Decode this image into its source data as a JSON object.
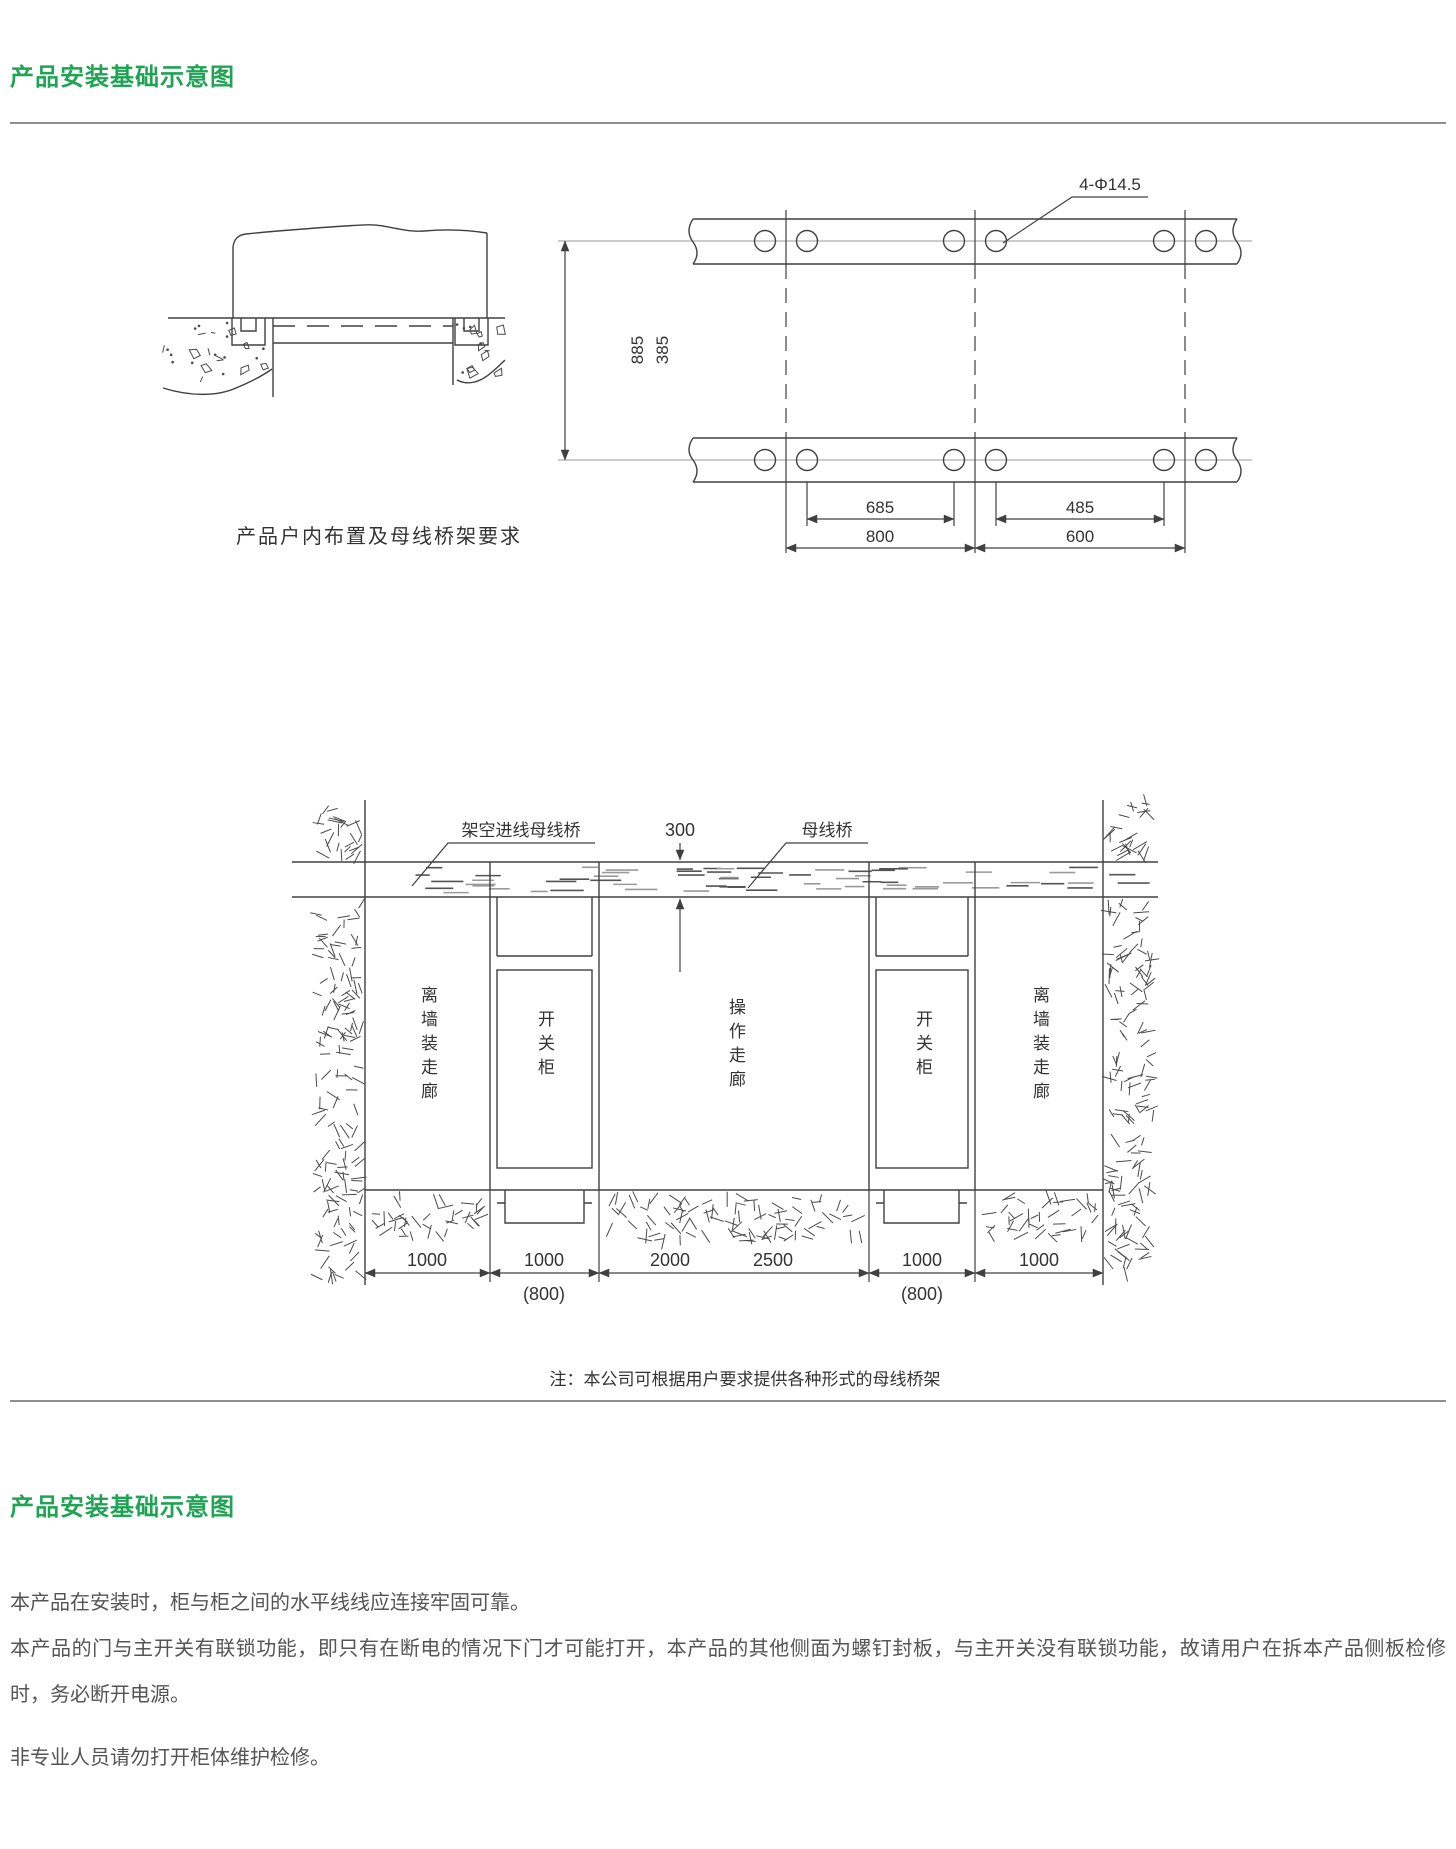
{
  "page": {
    "section1_title": "产品安装基础示意图",
    "section2_title": "产品安装基础示意图"
  },
  "diagram1": {
    "caption": "产品户内布置及母线桥架要求"
  },
  "plan": {
    "holes_label": "4-Φ14.5",
    "dim_vertical_outer": "885",
    "dim_vertical_inner": "385",
    "dim_hole_span_left": "685",
    "dim_hole_span_right": "485",
    "dim_panel_left": "800",
    "dim_panel_right": "600"
  },
  "elevation": {
    "label_overhead_bus": "架空进线母线桥",
    "dim_bus_height": "300",
    "label_bus_bridge": "母线桥",
    "label_left_corridor": "离墙装走廊",
    "label_cabinet_left": "开关柜",
    "label_operation_corridor": "操作走廊",
    "label_cabinet_right": "开关柜",
    "label_right_corridor": "离墙装走廊",
    "dim_1": "1000",
    "dim_2": "1000",
    "dim_2_alt": "(800)",
    "dim_3a": "2000",
    "dim_3b": "2500",
    "dim_4": "1000",
    "dim_4_alt": "(800)",
    "dim_5": "1000",
    "note": "注：本公司可根据用户要求提供各种形式的母线桥架"
  },
  "text_section": {
    "para1": "本产品在安装时，柜与柜之间的水平线线应连接牢固可靠。",
    "para2": "本产品的门与主开关有联锁功能，即只有在断电的情况下门才可能打开，本产品的其他侧面为螺钉封板，与主开关没有联锁功能，故请用户在拆本产品侧板检修时，务必断开电源。",
    "para3": "非专业人员请勿打开柜体维护检修。"
  },
  "colors": {
    "accent_green": "#1EA453",
    "divider_gray": "#8F8F8F",
    "line_dark": "#404040"
  }
}
